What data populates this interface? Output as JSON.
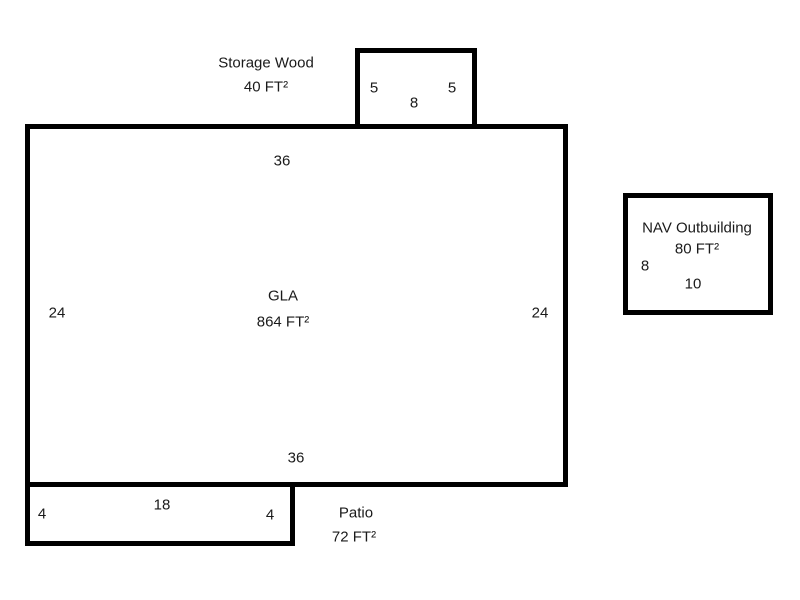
{
  "gla": {
    "label": "GLA",
    "area": "864 FT²",
    "dim_top": "36",
    "dim_bottom": "36",
    "dim_left": "24",
    "dim_right": "24"
  },
  "storage": {
    "label": "Storage Wood",
    "area": "40 FT²",
    "dim_left": "5",
    "dim_right": "5",
    "dim_bottom": "8"
  },
  "patio": {
    "label": "Patio",
    "area": "72 FT²",
    "dim_left": "4",
    "dim_top": "18",
    "dim_right": "4"
  },
  "outbuilding": {
    "label": "NAV Outbuilding",
    "area": "80 FT²",
    "dim_left": "8",
    "dim_bottom": "10"
  },
  "colors": {
    "line": "#000000",
    "text": "#1a1a1a",
    "background": "#ffffff"
  }
}
